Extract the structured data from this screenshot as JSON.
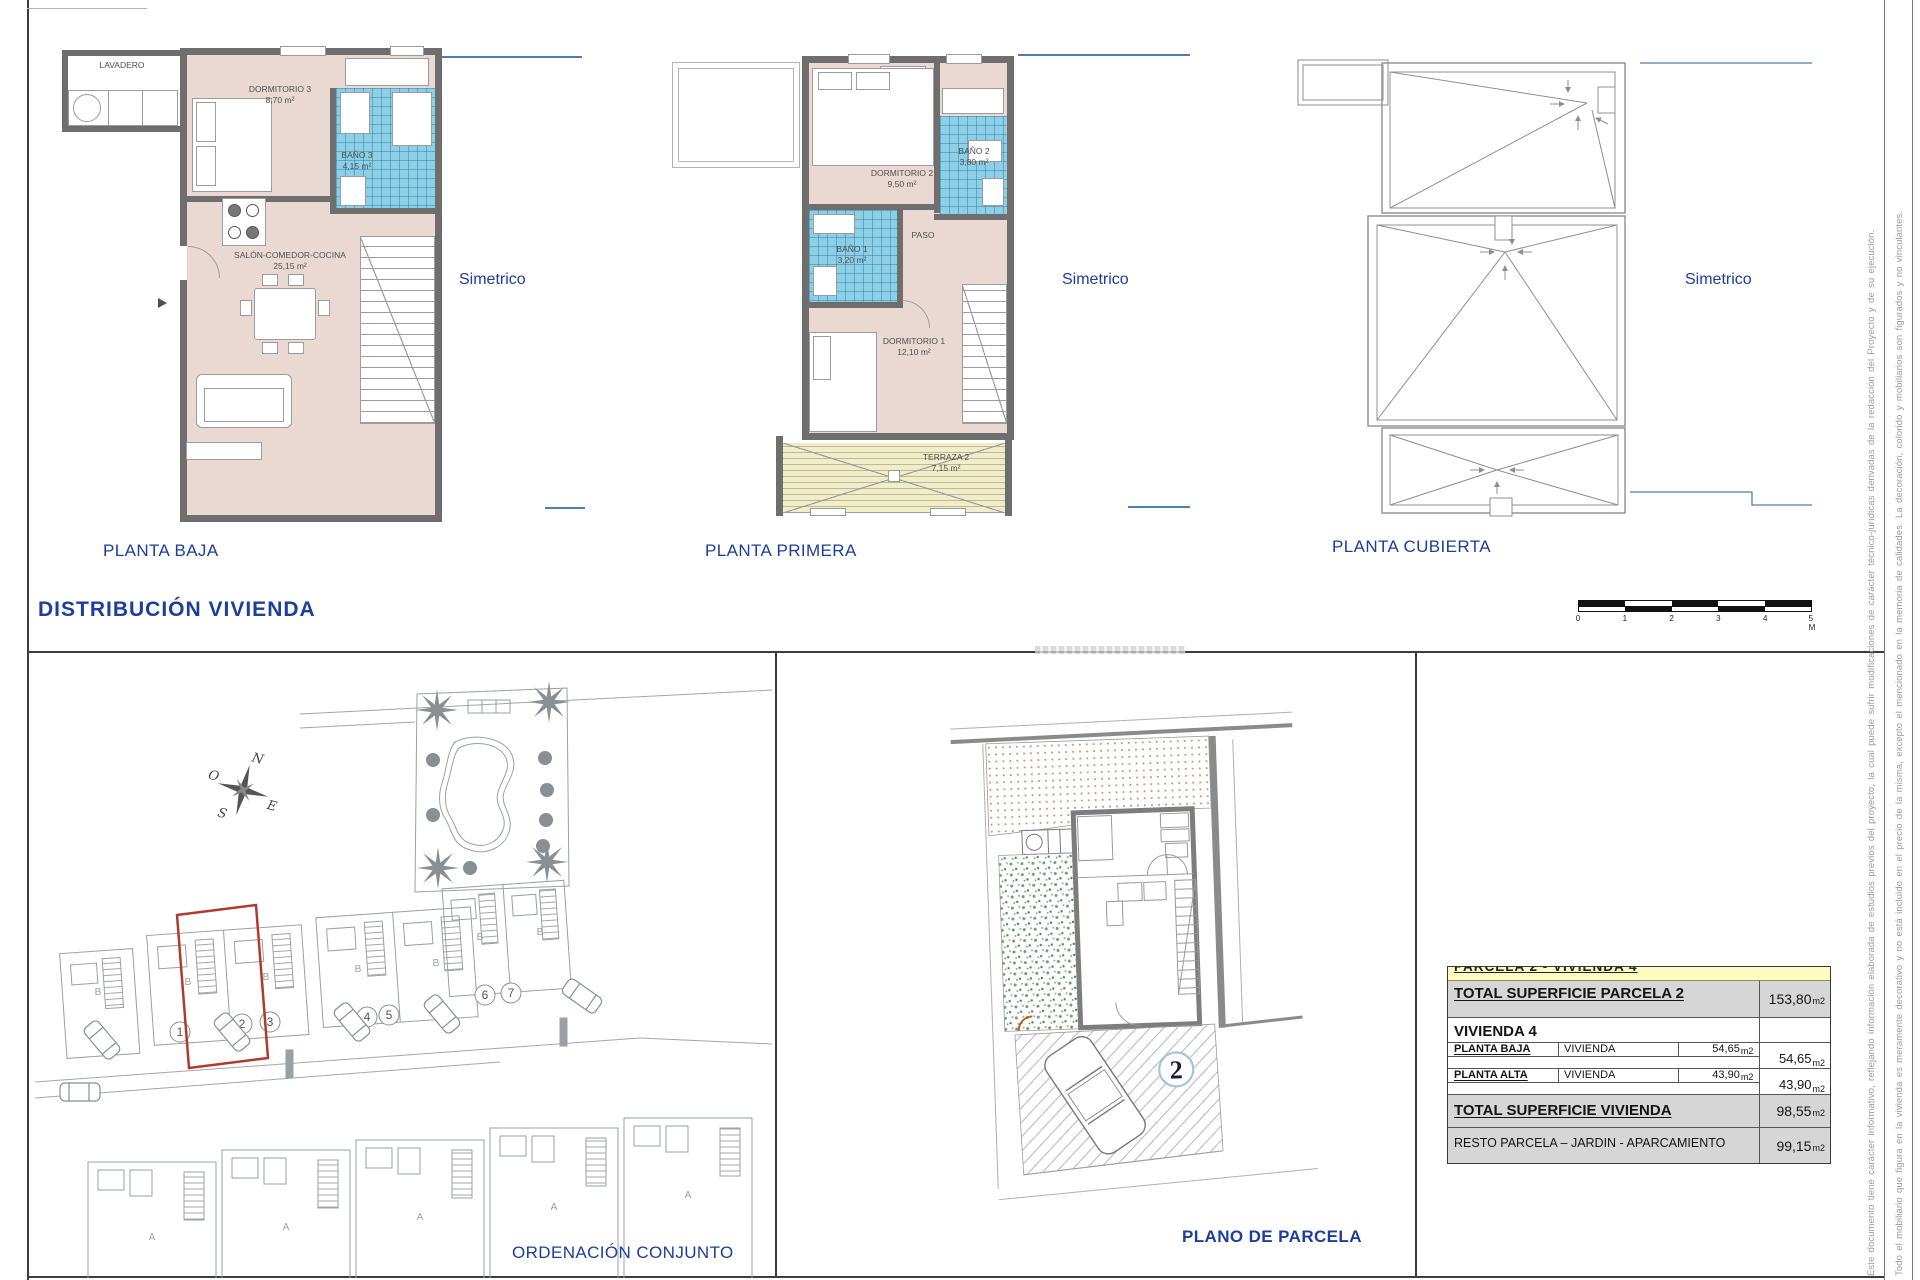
{
  "header": {
    "sheet_title": "DISTRIBUCIÓN  VIVIENDA"
  },
  "plans": {
    "baja": {
      "title": "PLANTA BAJA",
      "symmetry_note": "Simetrico",
      "rooms": {
        "lavadero": {
          "name": "LAVADERO"
        },
        "dormitorio3": {
          "name": "DORMITORIO 3",
          "area": "8,70 m²"
        },
        "bano3": {
          "name": "BAÑO 3",
          "area": "4,15 m²"
        },
        "salon": {
          "name": "SALÓN-COMEDOR-COCINA",
          "area": "25,15 m²"
        }
      }
    },
    "primera": {
      "title": "PLANTA PRIMERA",
      "symmetry_note": "Simetrico",
      "rooms": {
        "dormitorio2": {
          "name": "DORMITORIO 2",
          "area": "9,50 m²"
        },
        "bano2": {
          "name": "BAÑO 2",
          "area": "3,80 m²"
        },
        "paso": {
          "name": "PASO"
        },
        "bano1": {
          "name": "BAÑO 1",
          "area": "3,20 m²"
        },
        "dormitorio1": {
          "name": "DORMITORIO 1",
          "area": "12,10 m²"
        },
        "terraza2": {
          "name": "TERRAZA 2",
          "area": "7,15 m²"
        }
      }
    },
    "cubierta": {
      "title": "PLANTA CUBIERTA",
      "symmetry_note": "Simetrico"
    }
  },
  "scale_bar": {
    "labels": [
      "0",
      "1",
      "2",
      "3",
      "4",
      "5 M"
    ]
  },
  "site_plan": {
    "title": "ORDENACIÓN CONJUNTO",
    "compass": {
      "n": "N",
      "e": "E",
      "s": "S",
      "o": "O"
    },
    "unit_numbers": [
      "1",
      "2",
      "3",
      "4",
      "5",
      "6",
      "7"
    ],
    "row_b_label": "B",
    "row_a_label": "A"
  },
  "parcel_plan": {
    "title": "PLANO DE PARCELA",
    "parcel_number": "2"
  },
  "summary_table": {
    "clipped_header": "PARCELA 2 - VIVIENDA 4",
    "rows": {
      "parcela": {
        "label": "TOTAL  SUPERFICIE  PARCELA  2",
        "value": "153,80",
        "unit": "m2"
      },
      "vivienda4": {
        "label": "VIVIENDA  4"
      },
      "planta_baja": {
        "label": "PLANTA  BAJA",
        "use": "VIVIENDA",
        "area": "54,65",
        "unit": "m2",
        "subtotal": "54,65"
      },
      "planta_alta": {
        "label": "PLANTA  ALTA",
        "use": "VIVIENDA",
        "area": "43,90",
        "unit": "m2",
        "subtotal": "43,90"
      },
      "total_vivienda": {
        "label": "TOTAL  SUPERFICIE  VIVIENDA",
        "value": "98,55",
        "unit": "m2"
      },
      "resto": {
        "label": "RESTO PARCELA – JARDIN - APARCAMIENTO",
        "value": "99,15",
        "unit": "m2"
      }
    }
  },
  "margin_notes": {
    "line1": "Este documento tiene carácter informativo, reflejando información elaborada de estudios previos del proyecto, la cual puede sufrir modificaciones de carácter técnico-jurídicas derivadas de la redacción del Proyecto y de su ejecución.",
    "line2": "Todo el mobiliario que figura en la vivienda es meramente decorativo y no está incluido en el precio de la misma, excepto el mencionado en la memoria de calidades. La decoración, colorido y mobiliarios son figurados y no vinculantes."
  }
}
